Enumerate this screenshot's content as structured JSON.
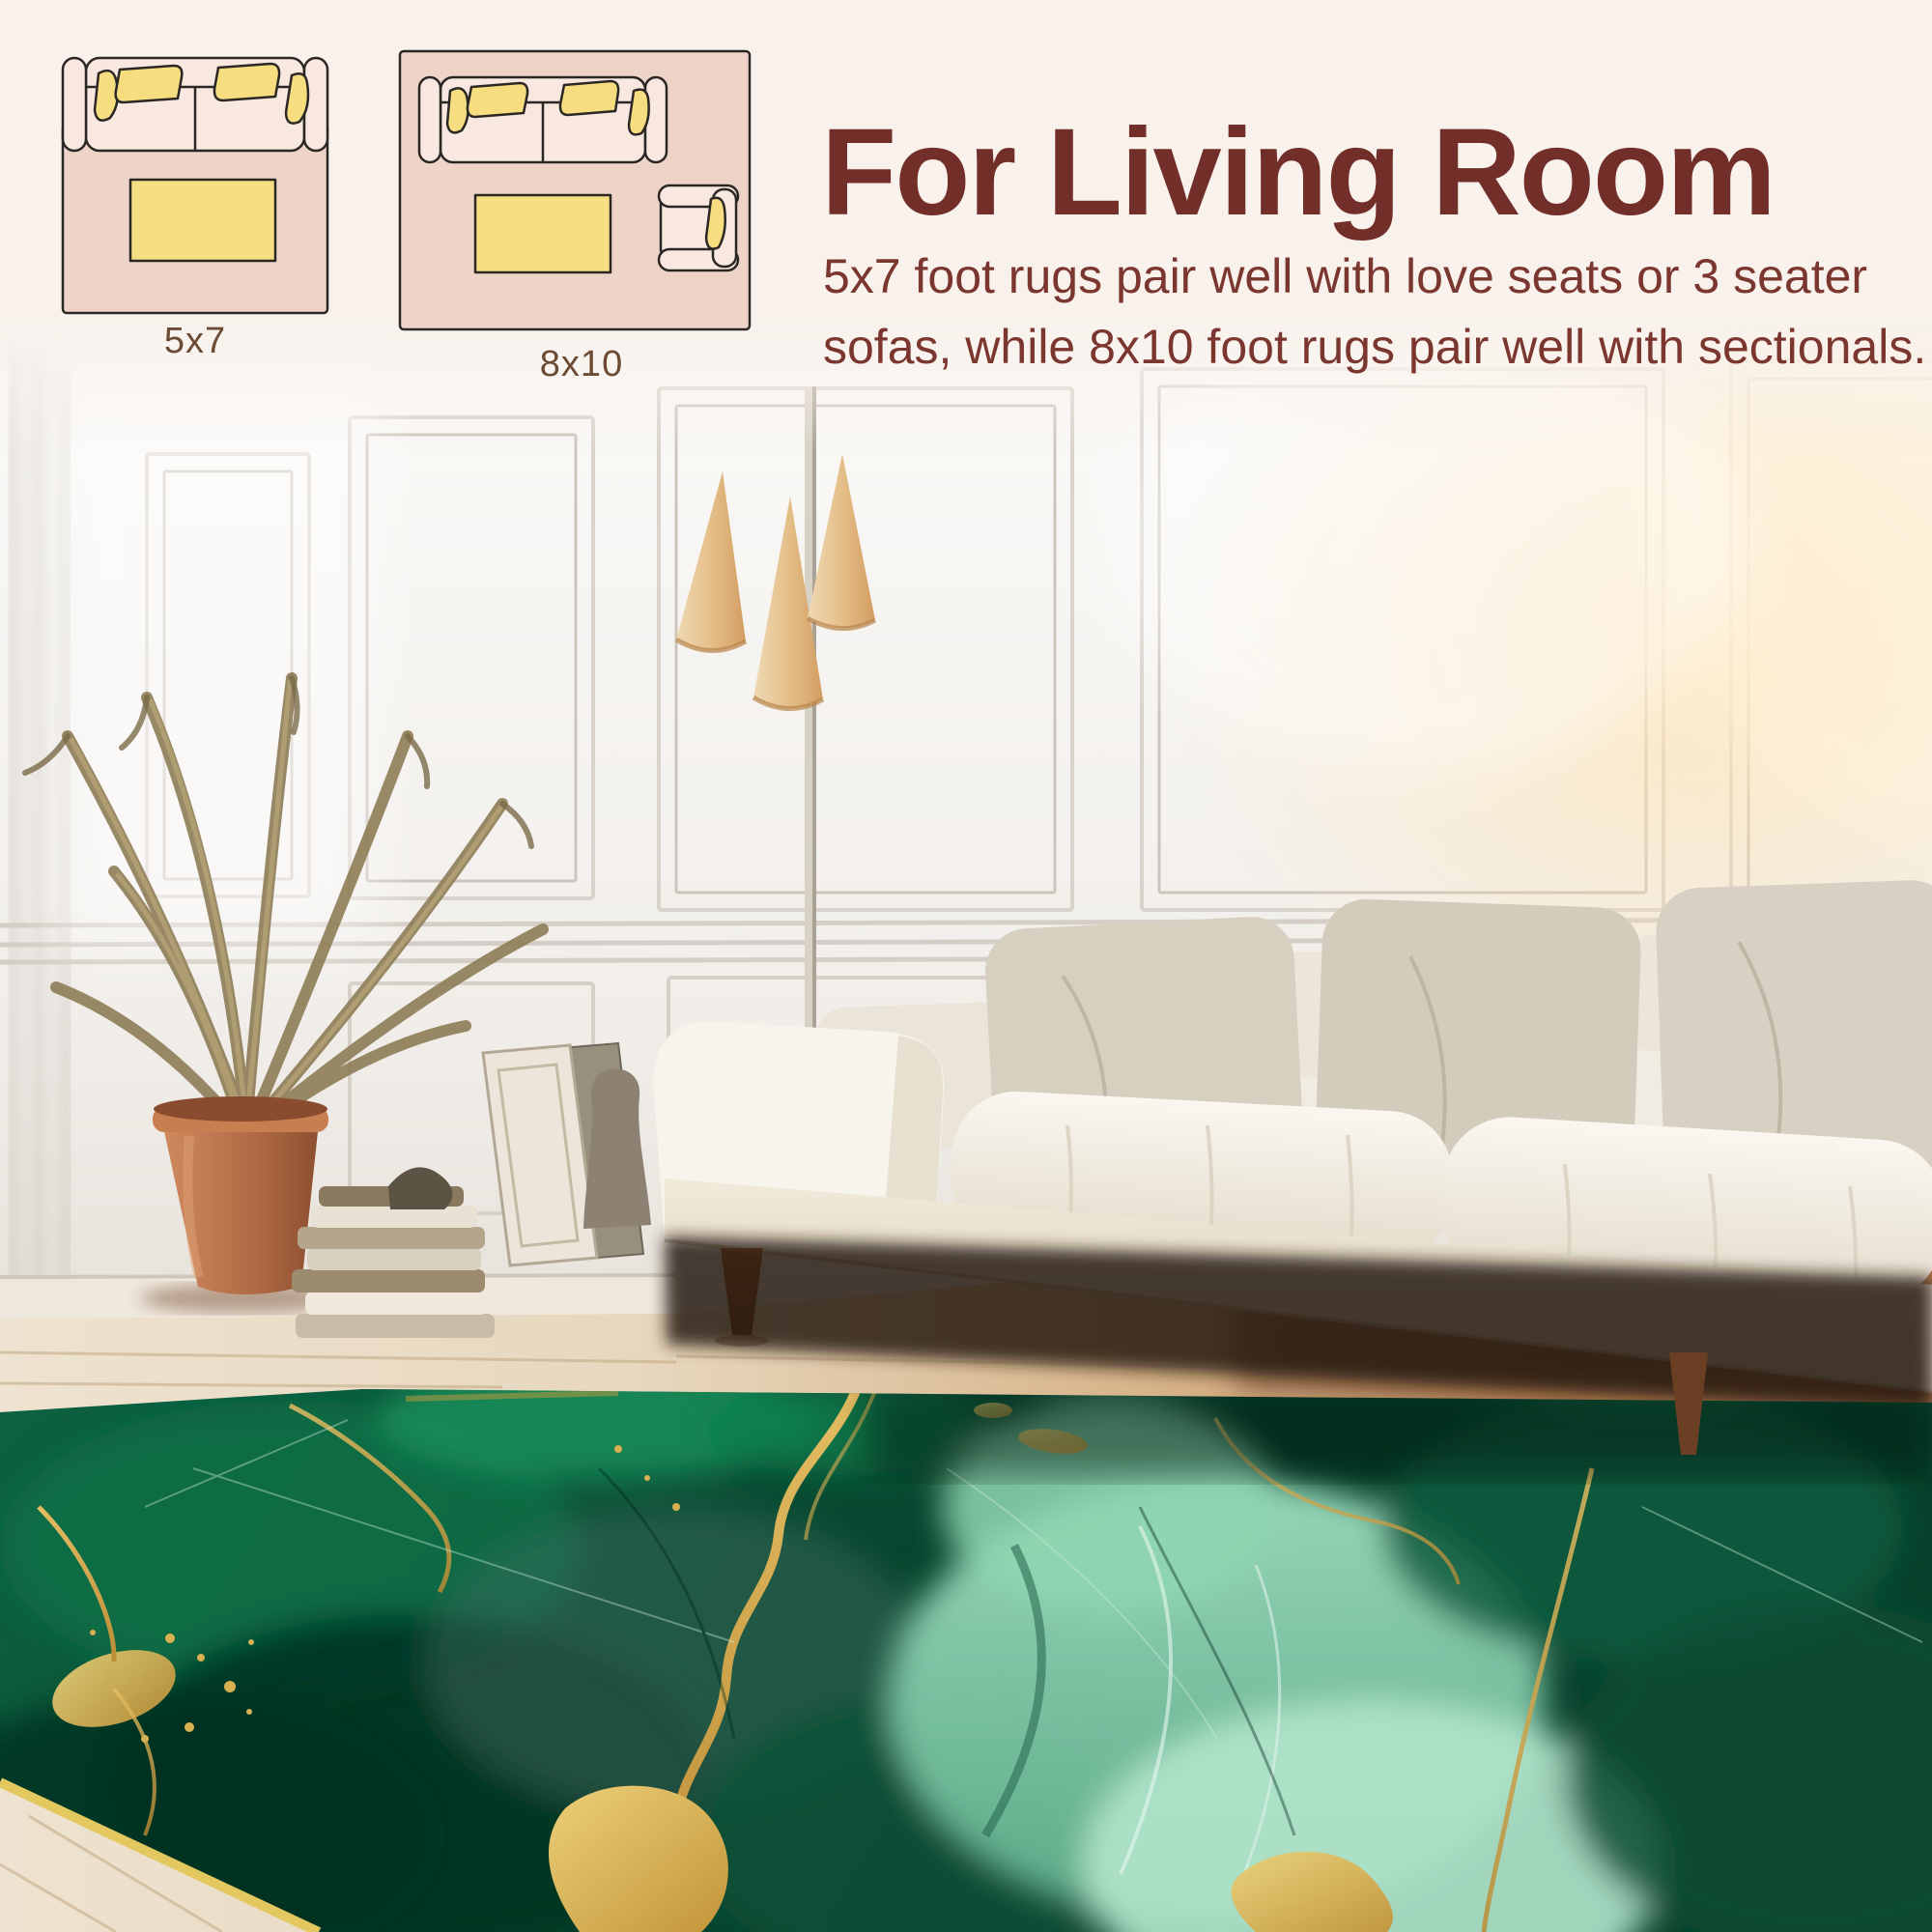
{
  "size_guide": {
    "heading": "For Living Room",
    "description_lines": [
      "5x7 foot rugs pair well with love seats or 3 seater",
      "sofas, while 8x10 foot rugs pair well with sectionals."
    ],
    "diagrams": [
      {
        "label": "5x7",
        "icon": "rug-with-loveseat-top-view-icon"
      },
      {
        "label": "8x10",
        "icon": "rug-with-sofa-and-armchair-top-view-icon"
      }
    ]
  },
  "scene_objects": [
    "panel-molding-wall",
    "floor-lamp-three-shades",
    "dried-palm-plant",
    "terracotta-pot",
    "stacked-books",
    "leaning-picture-frames",
    "decor-vase",
    "white-sofa",
    "greige-throw-pillows",
    "whitewashed-wood-floor",
    "green-gold-marble-rug"
  ],
  "colors": {
    "background_cream": "#f8f1ec",
    "heading_text": "#722e28",
    "body_text": "#7b372f",
    "label_text": "#6b4b33",
    "diagram_rug_pink": "#eed3c8",
    "diagram_furniture_fill": "#f9e8e0",
    "diagram_pillow_yellow": "#f6dd80",
    "diagram_outline": "#2b2724",
    "rug_emerald": "#0d6243",
    "rug_emerald_dark": "#073c28",
    "rug_seafoam": "#85cfad",
    "rug_gold": "#d2a64a",
    "sofa_white": "#f5f1e8",
    "pillow_greige": "#d6cfc0",
    "pot_terracotta": "#b06a44",
    "floor_wood_light": "#e9dcc8",
    "floor_wood_warm": "#c38a5e"
  }
}
